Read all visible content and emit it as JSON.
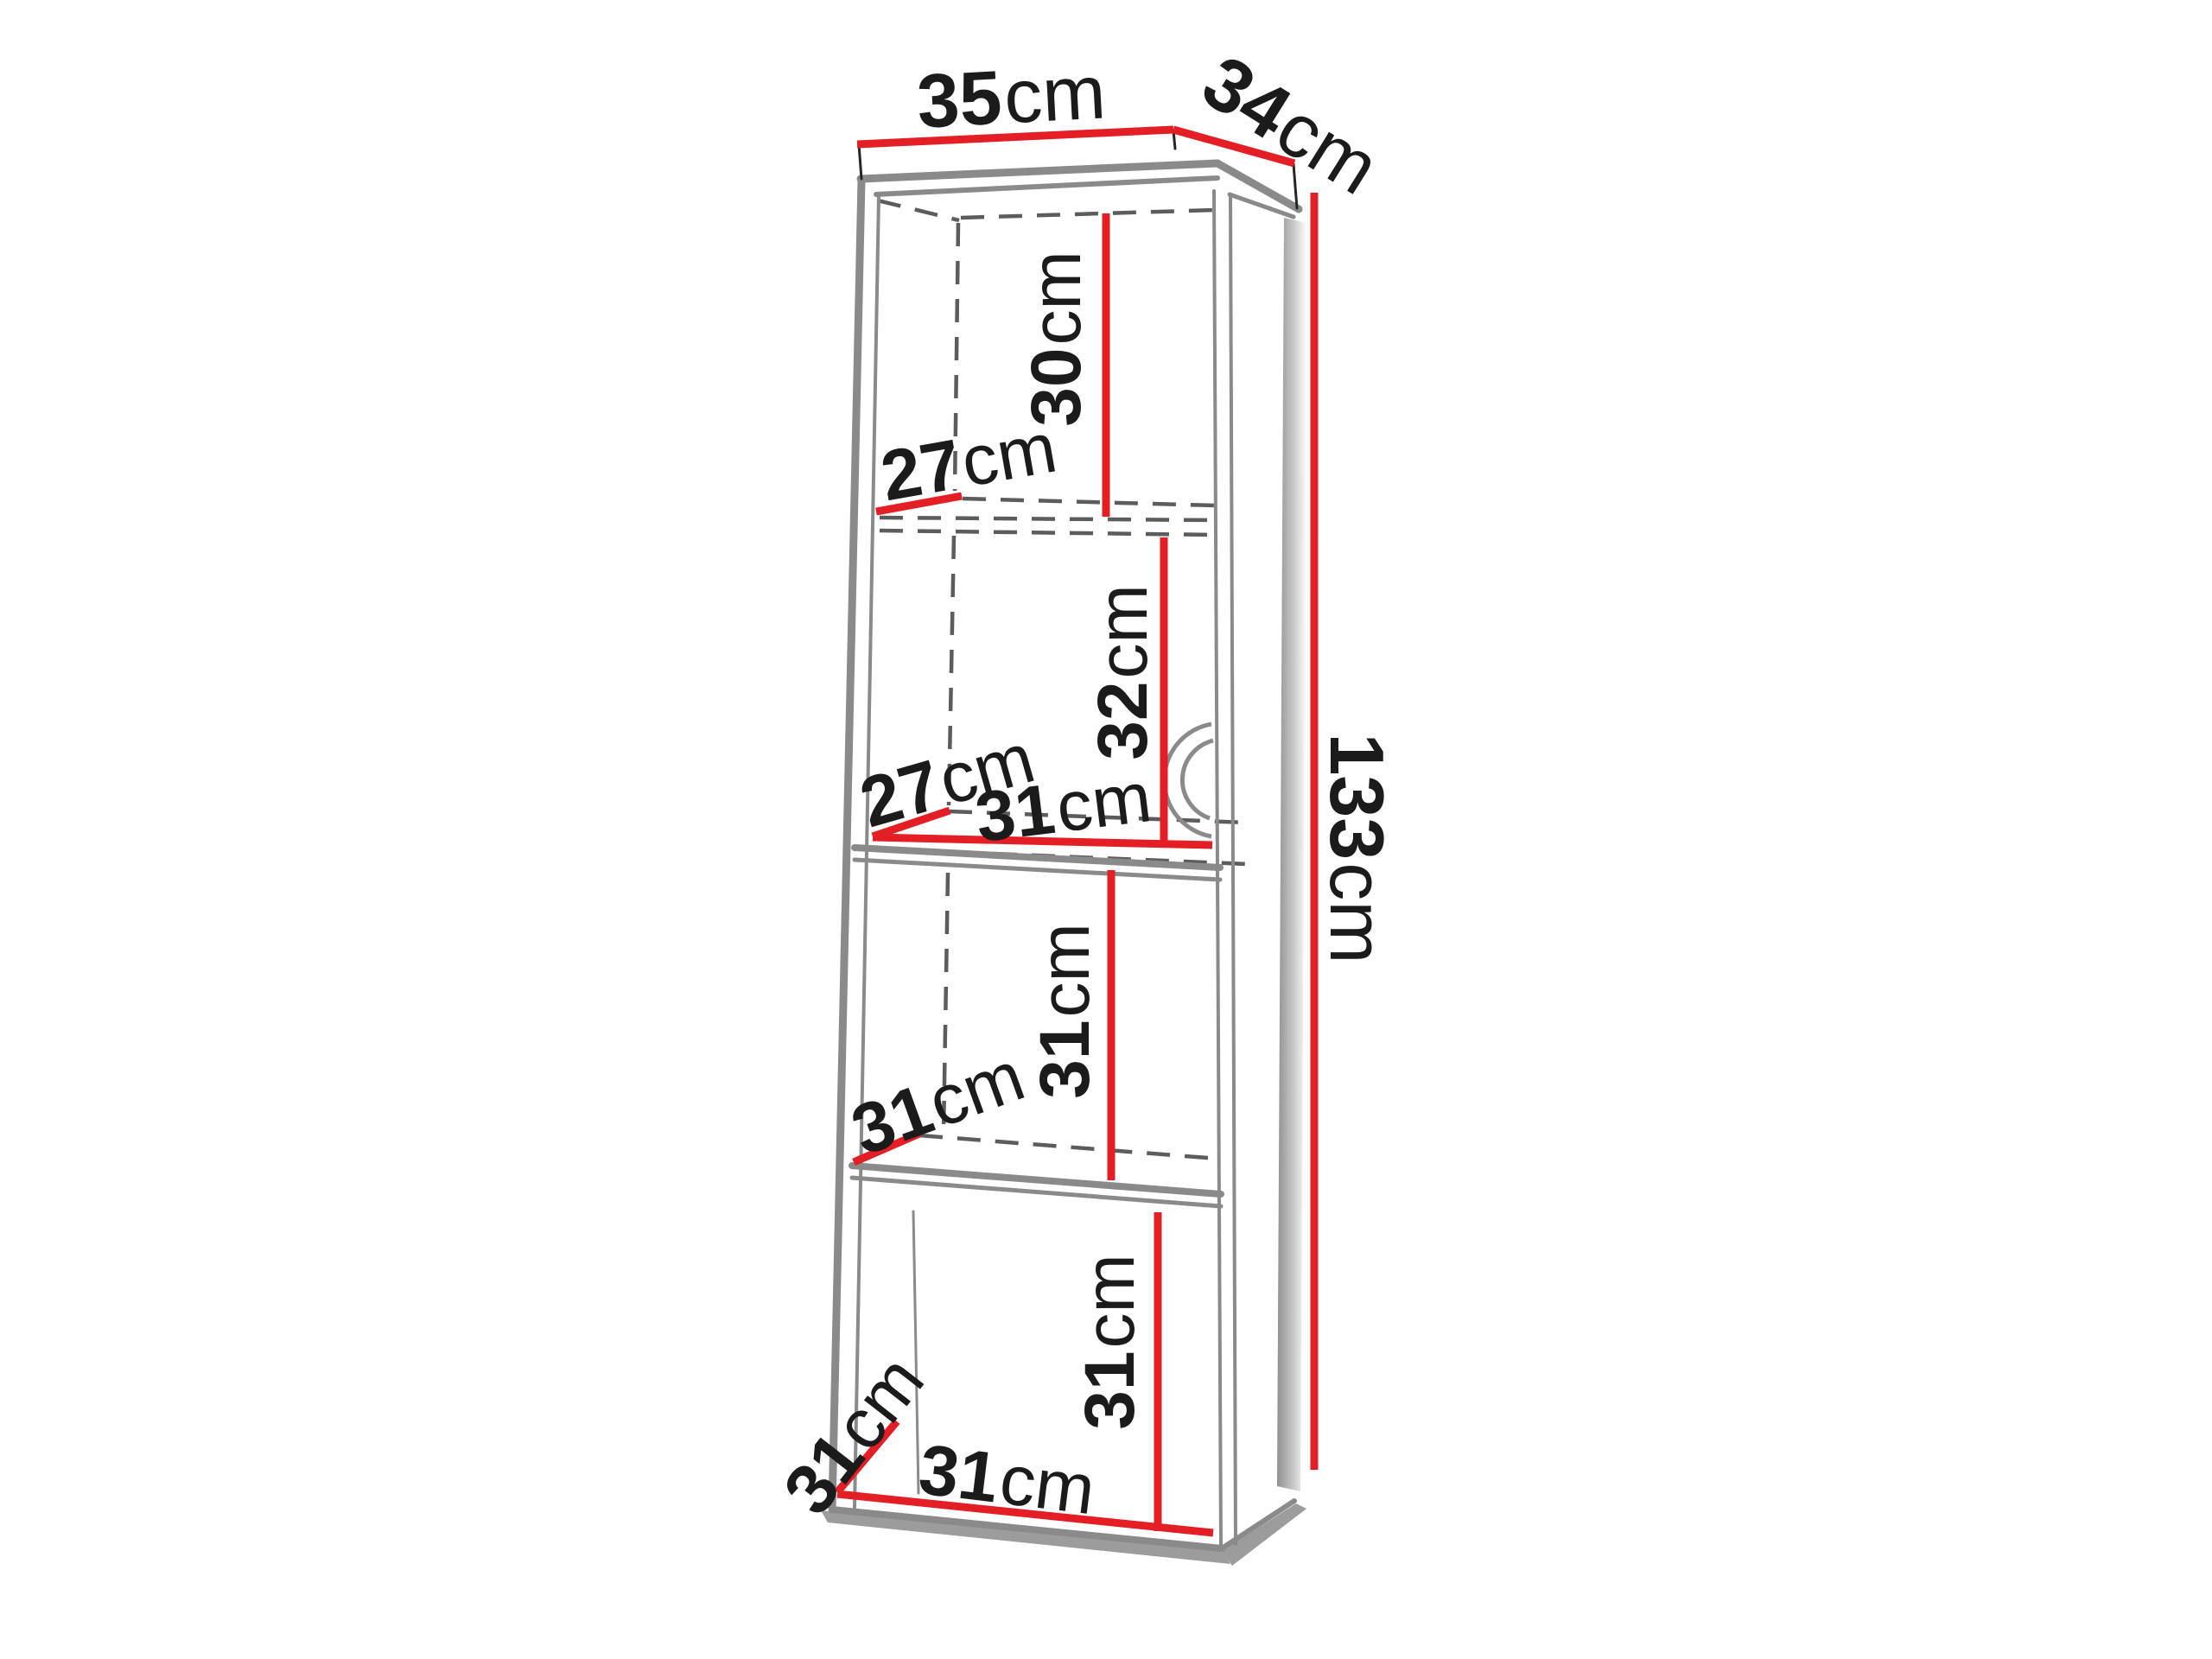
{
  "colors": {
    "measure": "#e31e24",
    "edge": "#8a8a8a",
    "dash": "#5c5c5c",
    "ink": "#1b1b1b",
    "shadow": "#9c9c9c",
    "panel_shade": "#8f8f8f"
  },
  "dimensions": {
    "top_width": {
      "value": "35",
      "unit": "cm"
    },
    "top_depth": {
      "value": "34",
      "unit": "cm"
    },
    "total_height": {
      "value": "133",
      "unit": "cm"
    },
    "section1_height": {
      "value": "30",
      "unit": "cm"
    },
    "shelf1_depth": {
      "value": "27",
      "unit": "cm"
    },
    "section2_height": {
      "value": "32",
      "unit": "cm"
    },
    "shelf2_depth": {
      "value": "27",
      "unit": "cm"
    },
    "shelf2_width": {
      "value": "31",
      "unit": "cm"
    },
    "section3_height": {
      "value": "31",
      "unit": "cm"
    },
    "shelf3_depth": {
      "value": "31",
      "unit": "cm"
    },
    "section4_height": {
      "value": "31",
      "unit": "cm"
    },
    "bottom_depth": {
      "value": "31",
      "unit": "cm"
    },
    "bottom_width": {
      "value": "31",
      "unit": "cm"
    }
  }
}
